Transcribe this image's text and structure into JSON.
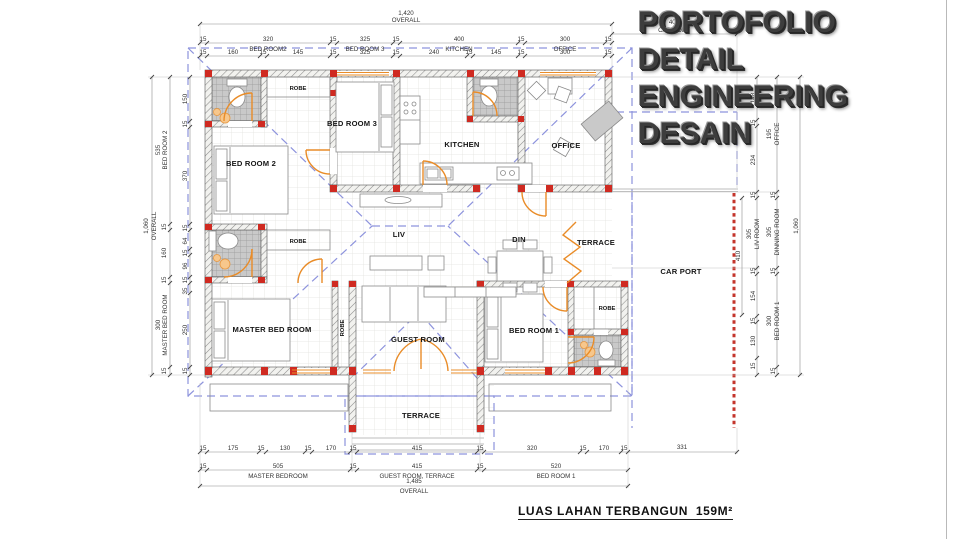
{
  "title": {
    "line1": "PORTOFOLIO",
    "line2": "DETAIL ENGINEERING",
    "line3": "DESAIN"
  },
  "caption": "LUAS LAHAN TERBANGUN  159M²",
  "rooms": {
    "bed_room_2": "BED ROOM 2",
    "bed_room_3": "BED ROOM 3",
    "kitchen": "KITCHEN",
    "office": "OFFICE",
    "liv": "LIV",
    "din": "DIN",
    "terrace_side": "TERRACE",
    "terrace_front": "TERRACE",
    "car_port": "CAR PORT",
    "master_bed_room": "MASTER BED ROOM",
    "guest_room": "GUEST ROOM",
    "bed_room_1": "BED ROOM 1",
    "robe_top": "ROBE",
    "robe_mid": "ROBE",
    "robe_guest": "ROBE",
    "robe_bed1": "ROBE"
  },
  "dims": {
    "top": {
      "overall": "1,420",
      "overall_label": "OVERALL",
      "row1": [
        "15",
        "320",
        "15",
        "325",
        "15",
        "400",
        "15",
        "300",
        "15"
      ],
      "row1_rooms": [
        "BED ROOM2",
        "BED ROOM 3",
        "KITCHEN",
        "OFFICE"
      ],
      "row2": [
        "15",
        "160",
        "15",
        "145",
        "15",
        "325",
        "15",
        "240",
        "15",
        "145",
        "15",
        "300",
        "15"
      ]
    },
    "bottom": {
      "overall": "1,485",
      "overall_label": "OVERALL",
      "row1": [
        "15",
        "175",
        "15",
        "130",
        "15",
        "170",
        "15",
        "415",
        "15",
        "320",
        "15",
        "170",
        "15"
      ],
      "row2": [
        "15",
        "505",
        "15",
        "415",
        "15",
        "520"
      ],
      "row2_rooms": [
        "MASTER BEDROOM",
        "GUEST ROOM, TERRACE",
        "BED ROOM 1"
      ],
      "car_port": "331"
    },
    "left": {
      "overall": "1,060",
      "overall_label": "OVERALL",
      "col1": [
        "535",
        "15",
        "160",
        "15",
        "300",
        "15"
      ],
      "col1_rooms": [
        "BED ROOM 2",
        "MASTER BED ROOM"
      ],
      "col2": [
        "150",
        "15",
        "370",
        "15",
        "64",
        "15",
        "96",
        "15",
        "35",
        "250",
        "15"
      ]
    },
    "right": {
      "overall": "1,060",
      "col1": [
        "195",
        "15",
        "305",
        "15",
        "300",
        "15"
      ],
      "col1_rooms": [
        "OFFICE",
        "DINNING ROOM",
        "BED ROOM 1"
      ],
      "col2": [
        "148",
        "15",
        "234",
        "15",
        "305",
        "15",
        "154",
        "15",
        "130",
        "15"
      ],
      "col2_room": "LIV ROOM",
      "col3": "410",
      "car_port": "400",
      "car_port_label": "CAR PORT"
    }
  }
}
